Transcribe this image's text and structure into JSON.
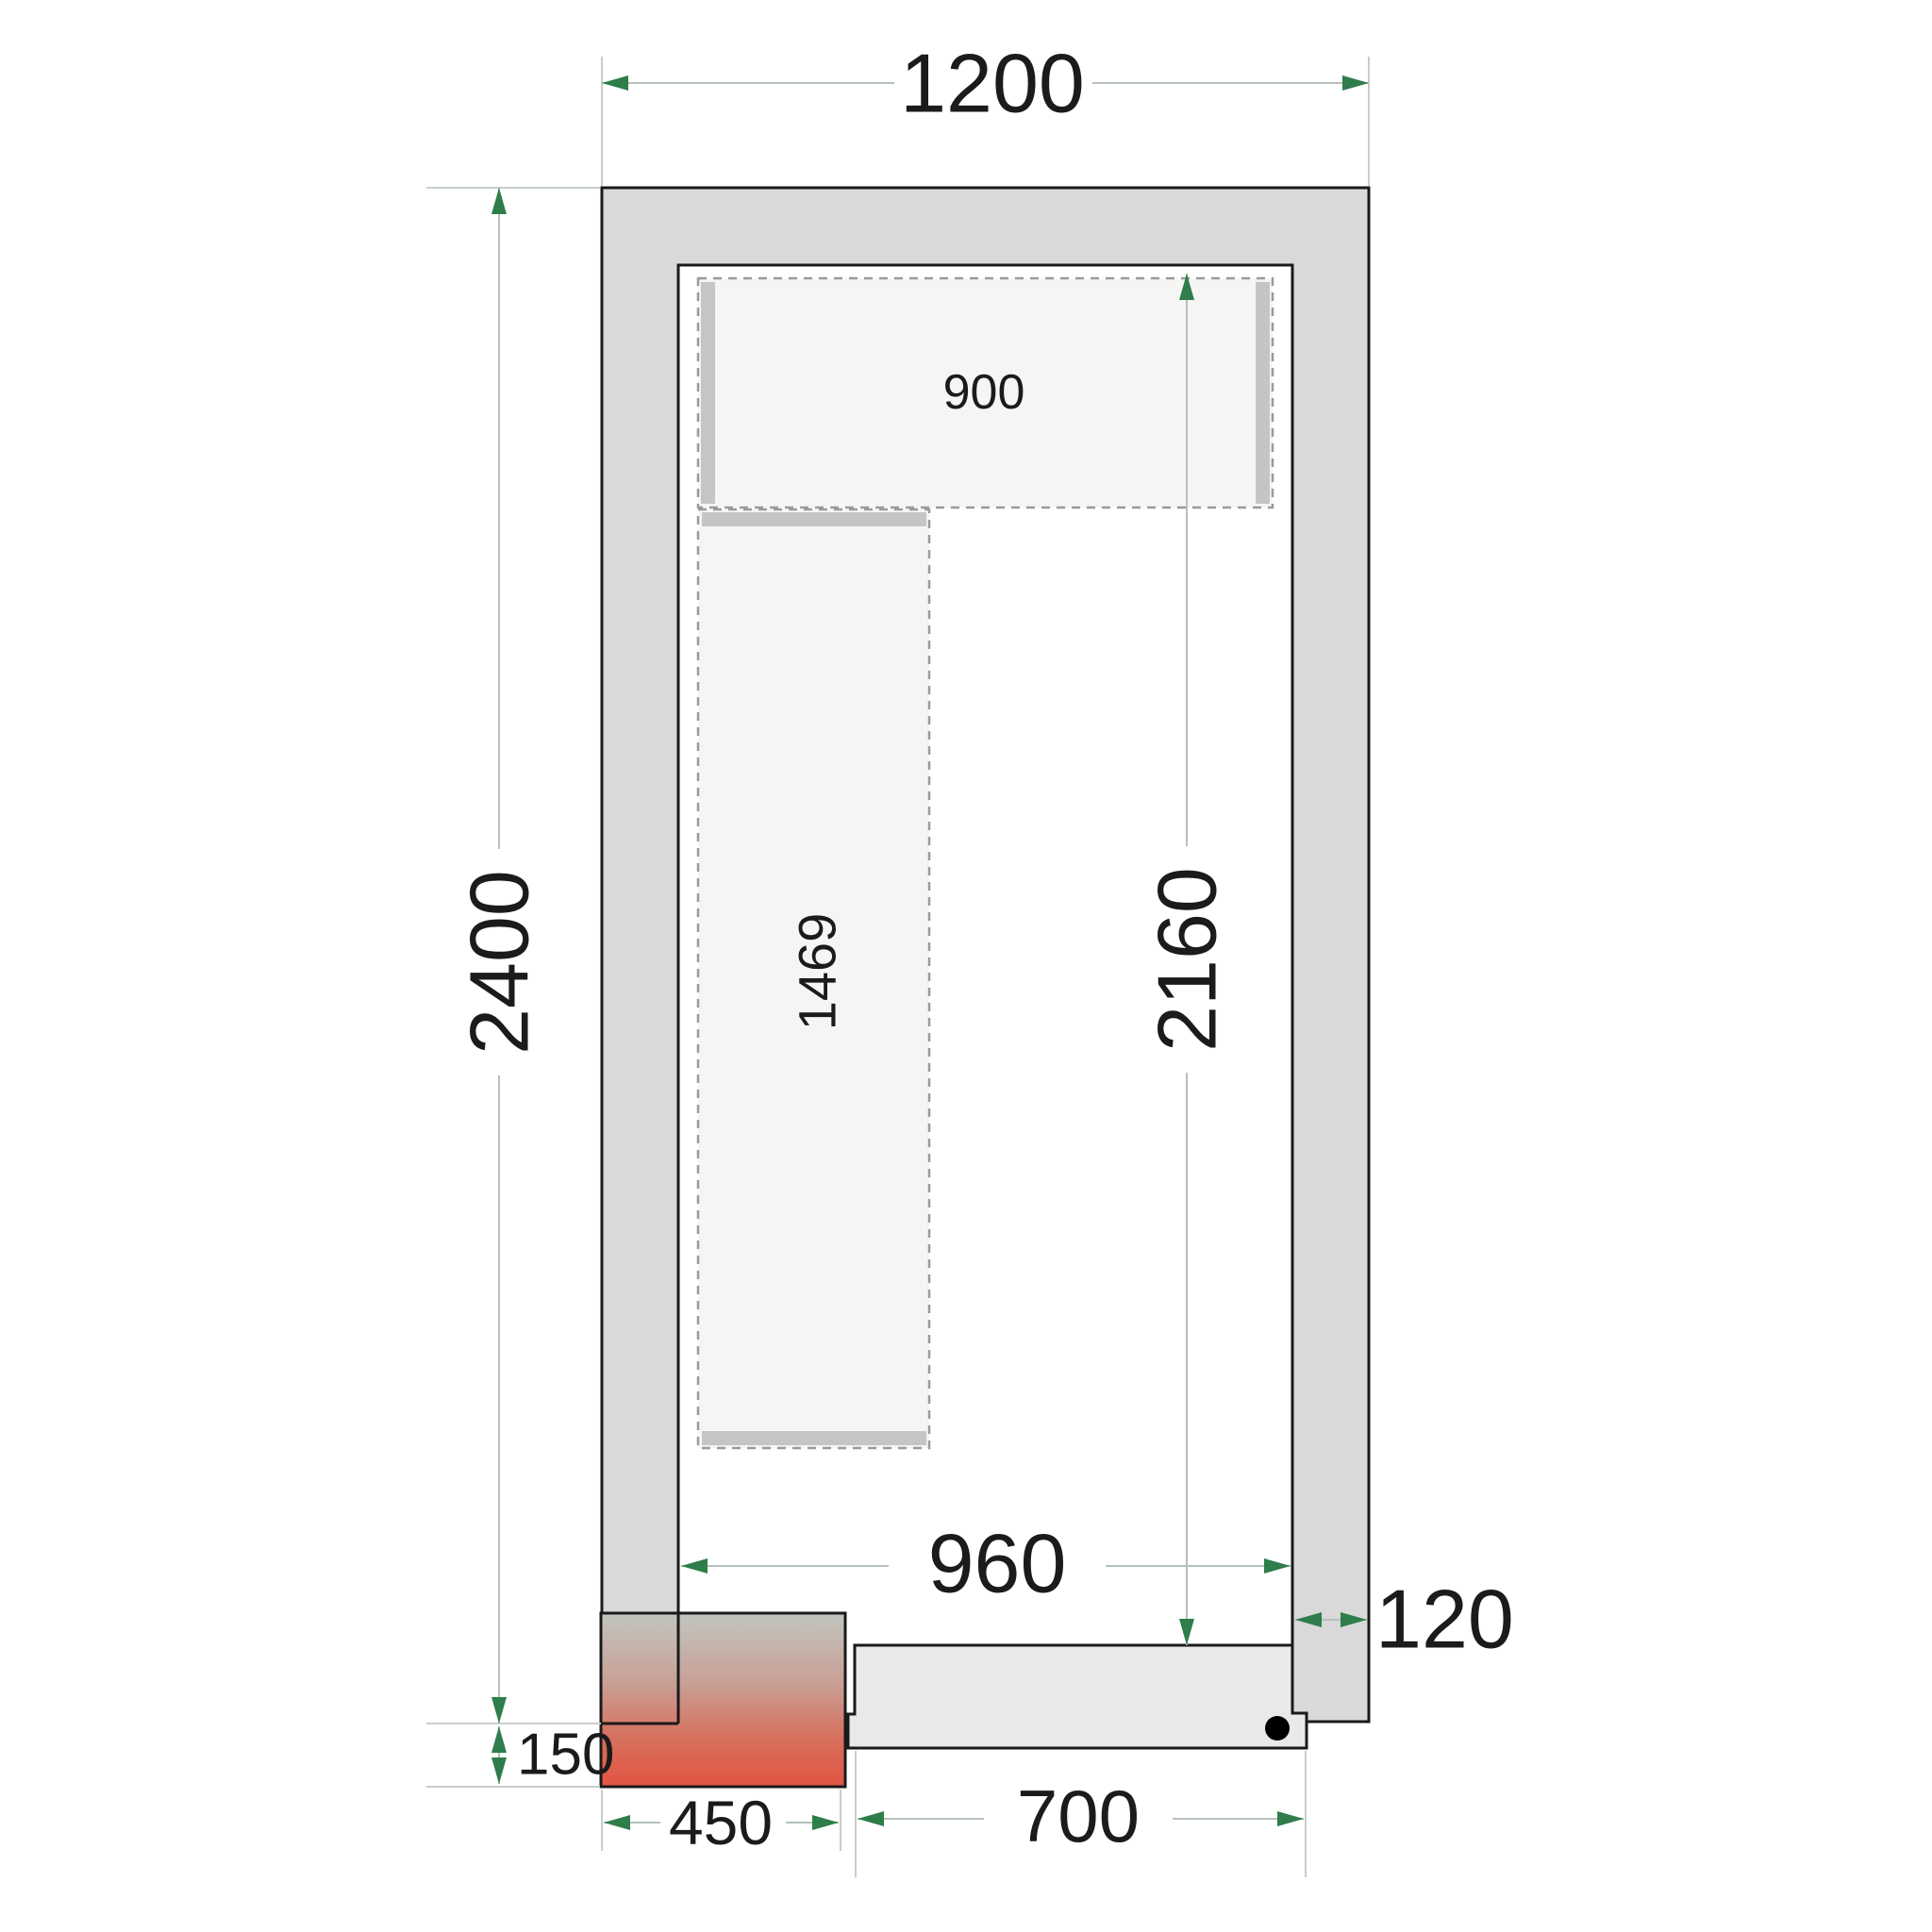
{
  "diagram": {
    "type": "floor-plan",
    "description": "Cold room floor plan (top view) with wall panels, two shelves, hinged door and corner condensing unit",
    "labels": {
      "outer_width": "1200",
      "outer_height": "2400",
      "interior_width": "960",
      "interior_height": "2160",
      "wall_thickness": "120",
      "top_shelf_length": "900",
      "side_shelf_length": "1469",
      "unit_width": "450",
      "unit_protrusion": "150",
      "door_width": "700"
    },
    "colors": {
      "wall_fill": "#d9d9d9",
      "outline": "#1a1a1a",
      "shelf_fill": "#f5f5f4",
      "shelf_dash": "#9a9a9a",
      "bracket": "#c5c5c5",
      "door_fill": "#e9e9e9",
      "dim_line": "#b5c2ba",
      "ext_line": "#c6cfc9",
      "arrow_green": "#2e7d4a",
      "label_text": "#1b1b1b",
      "unit_gradient_top": "#c2c5bf",
      "unit_gradient_bottom": "#e35442"
    }
  }
}
